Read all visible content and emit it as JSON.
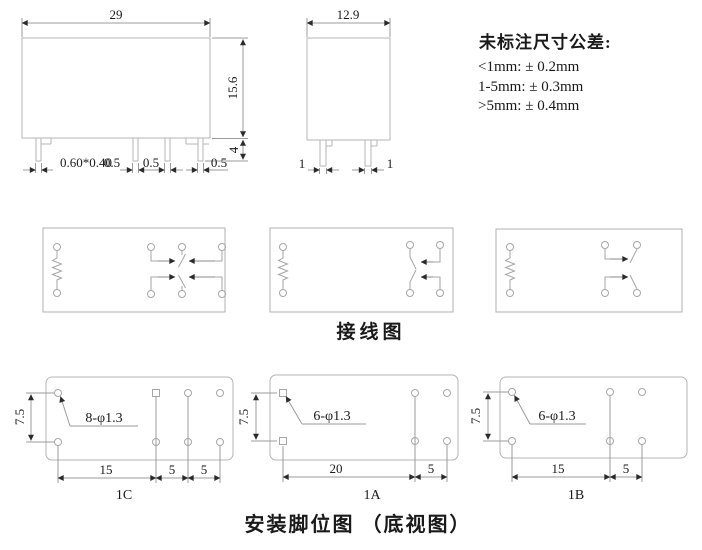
{
  "side_view": {
    "width": "29",
    "height": "15.6",
    "pin_length": "4",
    "pin_section": "0.60*0.40",
    "pin_widths": [
      "0.5",
      "0.5",
      "0.5"
    ]
  },
  "front_view": {
    "width": "12.9",
    "pin_widths": [
      "1",
      "1"
    ]
  },
  "tolerance_note": {
    "title": "未标注尺寸公差:",
    "lines": [
      "<1mm: ± 0.2mm",
      "1-5mm: ± 0.3mm",
      ">5mm: ± 0.4mm"
    ]
  },
  "wiring": {
    "caption": "接线图"
  },
  "footprint": {
    "caption": "安装脚位图 （底视图）",
    "layouts": [
      {
        "label": "1C",
        "hole_callout": "8-φ1.3",
        "row_pitch": "7.5",
        "spans": [
          "15",
          "5",
          "5"
        ]
      },
      {
        "label": "1A",
        "hole_callout": "6-φ1.3",
        "row_pitch": "7.5",
        "spans": [
          "20",
          "5"
        ]
      },
      {
        "label": "1B",
        "hole_callout": "6-φ1.3",
        "row_pitch": "7.5",
        "spans": [
          "15",
          "5"
        ]
      }
    ]
  },
  "colors": {
    "shape_line": "#b4b4b4",
    "dim_line": "#9b9b9b",
    "arrow": "#2b2b2b",
    "text": "#1a1a1a",
    "background": "#ffffff"
  }
}
